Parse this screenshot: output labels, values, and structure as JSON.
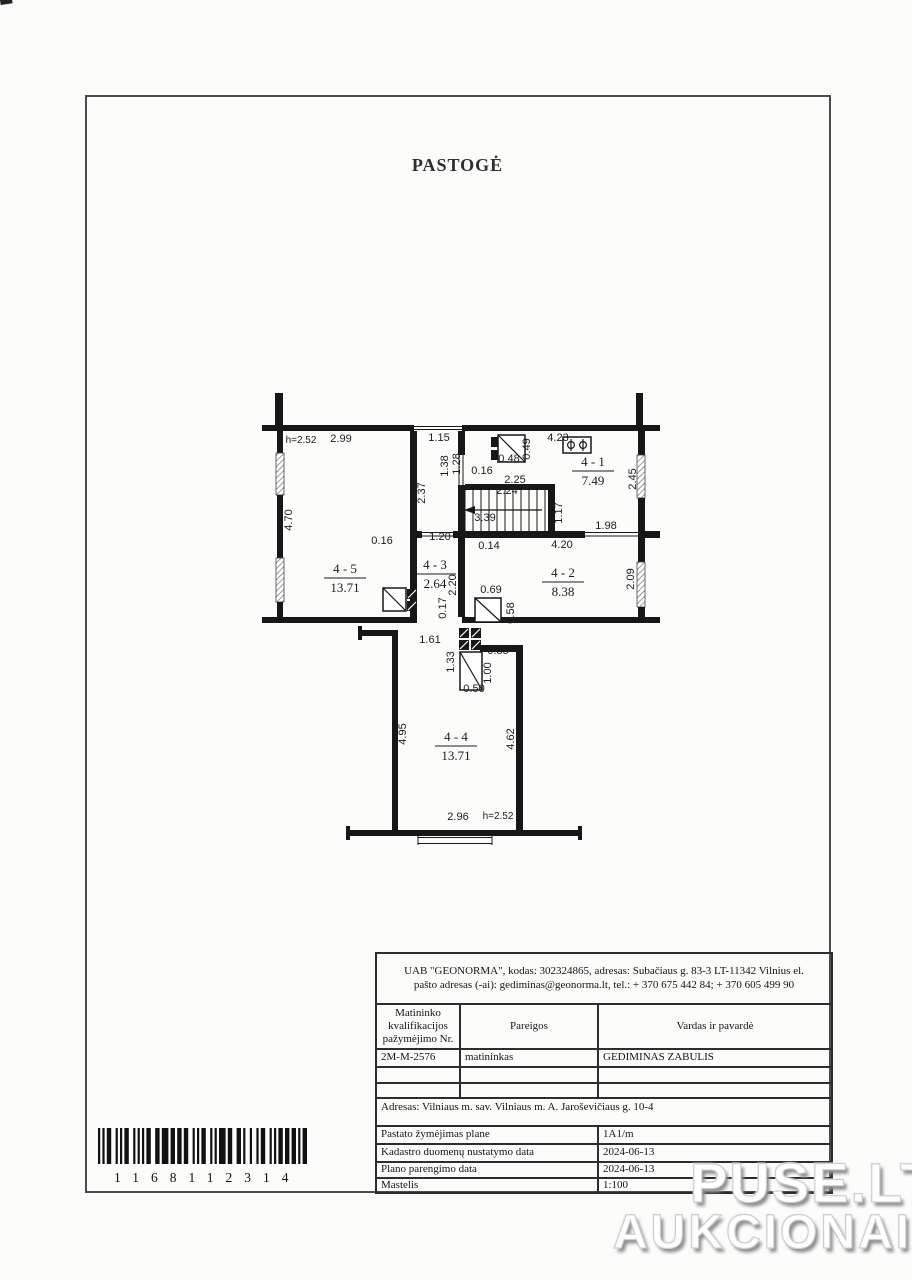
{
  "page": {
    "title": "PASTOGĖ",
    "watermark_line1": "PUSE.LT",
    "watermark_line2": "AUKCIONAI",
    "barcode_digits": "1168112314"
  },
  "plan": {
    "rooms": [
      {
        "num": "4 - 5",
        "area": "13.71",
        "x": 90,
        "y": 193
      },
      {
        "num": "4 - 1",
        "area": "7.49",
        "x": 338,
        "y": 86
      },
      {
        "num": "4 - 2",
        "area": "8.38",
        "x": 308,
        "y": 197
      },
      {
        "num": "4 - 3",
        "area": "2.64",
        "x": 180,
        "y": 189
      },
      {
        "num": "4 - 4",
        "area": "13.71",
        "x": 201,
        "y": 361
      }
    ],
    "dims": [
      {
        "t": "h=2.52",
        "x": 46,
        "y": 63,
        "s": 1
      },
      {
        "t": "2.99",
        "x": 86,
        "y": 62
      },
      {
        "t": "4.70",
        "x": 37,
        "y": 140,
        "r": -90
      },
      {
        "t": "0.16",
        "x": 127,
        "y": 164
      },
      {
        "t": "1.15",
        "x": 184,
        "y": 61
      },
      {
        "t": "2.37",
        "x": 170,
        "y": 113,
        "r": -90
      },
      {
        "t": "1.38",
        "x": 193,
        "y": 86,
        "r": -90
      },
      {
        "t": "1.28",
        "x": 205,
        "y": 84,
        "r": -90
      },
      {
        "t": "0.16",
        "x": 227,
        "y": 94
      },
      {
        "t": "0.48",
        "x": 254,
        "y": 82
      },
      {
        "t": "0.49",
        "x": 275,
        "y": 69,
        "r": -90
      },
      {
        "t": "2.25",
        "x": 260,
        "y": 103
      },
      {
        "t": "4.23",
        "x": 303,
        "y": 61
      },
      {
        "t": "2.24",
        "x": 252,
        "y": 114
      },
      {
        "t": "3.39",
        "x": 230,
        "y": 141
      },
      {
        "t": "1.17",
        "x": 307,
        "y": 133,
        "r": -90
      },
      {
        "t": "1.98",
        "x": 351,
        "y": 149
      },
      {
        "t": "2.45",
        "x": 381,
        "y": 99,
        "r": -90
      },
      {
        "t": "0.14",
        "x": 234,
        "y": 169
      },
      {
        "t": "4.20",
        "x": 307,
        "y": 168
      },
      {
        "t": "2.09",
        "x": 379,
        "y": 199,
        "r": -90
      },
      {
        "t": "0.69",
        "x": 236,
        "y": 213
      },
      {
        "t": "0.58",
        "x": 259,
        "y": 233,
        "r": -90
      },
      {
        "t": "1.20",
        "x": 185,
        "y": 160
      },
      {
        "t": "2.20",
        "x": 201,
        "y": 205,
        "r": -90
      },
      {
        "t": "0.17",
        "x": 191,
        "y": 228,
        "r": -90
      },
      {
        "t": "1.61",
        "x": 175,
        "y": 263
      },
      {
        "t": "1.33",
        "x": 199,
        "y": 282,
        "r": -90
      },
      {
        "t": "0.85",
        "x": 243,
        "y": 274
      },
      {
        "t": "1.00",
        "x": 236,
        "y": 293,
        "r": -90
      },
      {
        "t": "0.50",
        "x": 219,
        "y": 312
      },
      {
        "t": "4.95",
        "x": 151,
        "y": 354,
        "r": -90
      },
      {
        "t": "4.62",
        "x": 259,
        "y": 359,
        "r": -90
      },
      {
        "t": "2.96",
        "x": 203,
        "y": 440
      },
      {
        "t": "h=2.52",
        "x": 243,
        "y": 439,
        "s": 1
      }
    ]
  },
  "table": {
    "company_info": "UAB \"GEONORMA\", kodas: 302324865, adresas: Subačiaus g. 83-3 LT-11342 Vilnius el. pašto adresas (-ai): gediminas@geonorma.lt, tel.: + 370 675 442 84; + 370 605 499 90",
    "columns": [
      "Matininko kvalifikacijos pažymėjimo Nr.",
      "Pareigos",
      "Vardas ir pavardė"
    ],
    "surveyor_row": {
      "cert_no": "2M-M-2576",
      "position": "matininkas",
      "name": "GEDIMINAS ZABULIS"
    },
    "address": "Adresas: Vilniaus m. sav. Vilniaus m. A. Jaroševičiaus g. 10-4",
    "detail_rows": [
      {
        "label": "Pastato žymėjimas plane",
        "value": "1A1/m"
      },
      {
        "label": "Kadastro duomenų nustatymo data",
        "value": "2024-06-13"
      },
      {
        "label": "Plano parengimo data",
        "value": "2024-06-13"
      },
      {
        "label": "Mastelis",
        "value": "1:100"
      }
    ]
  }
}
